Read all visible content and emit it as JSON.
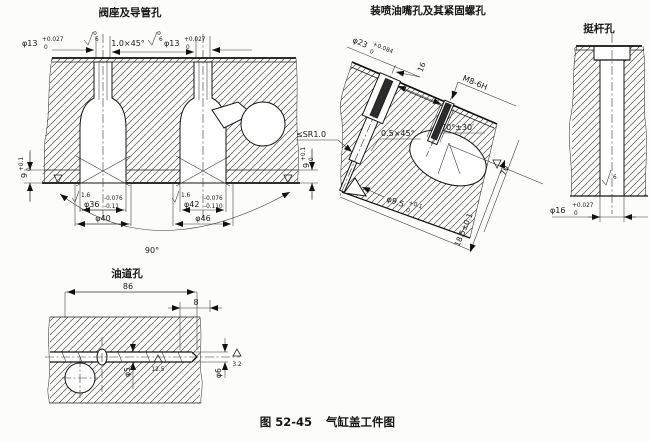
{
  "figure": {
    "caption_number": "图 52-45",
    "caption_title": "气缸盖工件图"
  },
  "valve_view": {
    "title": "阀座及导管孔",
    "dia13_left": {
      "main": "φ13",
      "sup": "+0.027",
      "sub": "0"
    },
    "chamfer": "1.0×45°",
    "dia13_right": {
      "main": "φ13",
      "sup": "+0.027",
      "sub": "0"
    },
    "rough_top_left": "6",
    "rough_top_right": "6",
    "height_left": {
      "main": "9",
      "sup": "+0.1",
      "sub": "0"
    },
    "height_right": {
      "main": "9",
      "sup": "+0.1",
      "sub": "0"
    },
    "seat_left": {
      "main": "φ36",
      "sup": "-0.076",
      "sub": "-0.11"
    },
    "seat_left_outer": "φ40",
    "rough_seat_left": "1.6",
    "seat_right": {
      "main": "φ42",
      "sup": "-0.076",
      "sub": "-0.110"
    },
    "seat_right_outer": "φ46",
    "rough_seat_right": "1.6",
    "seat_angle": "90°"
  },
  "injector_view": {
    "title": "装喷油嘴孔及其紧固螺孔",
    "dia23": {
      "main": "φ23",
      "sup": "+0.084",
      "sub": "0"
    },
    "dim16": "16",
    "thread": "M8-6H",
    "chamfer": "0.5×45°",
    "angle": "70°±30′",
    "nozzle": {
      "main": "φ9.5",
      "sup": "+0.1",
      "sub": "0"
    },
    "depth": "70",
    "offset": "18.5±0.1",
    "seat_note": "≤SR1.0"
  },
  "tappet_view": {
    "title": "挺杆孔",
    "bore": {
      "main": "φ16",
      "sup": "+0.027",
      "sub": "0"
    },
    "rough": "6"
  },
  "oil_view": {
    "title": "油道孔",
    "len86": "86",
    "len8": "8",
    "dia5": "φ5",
    "rough125": "12.5",
    "dia6": "φ6",
    "rough32": "3.2"
  }
}
